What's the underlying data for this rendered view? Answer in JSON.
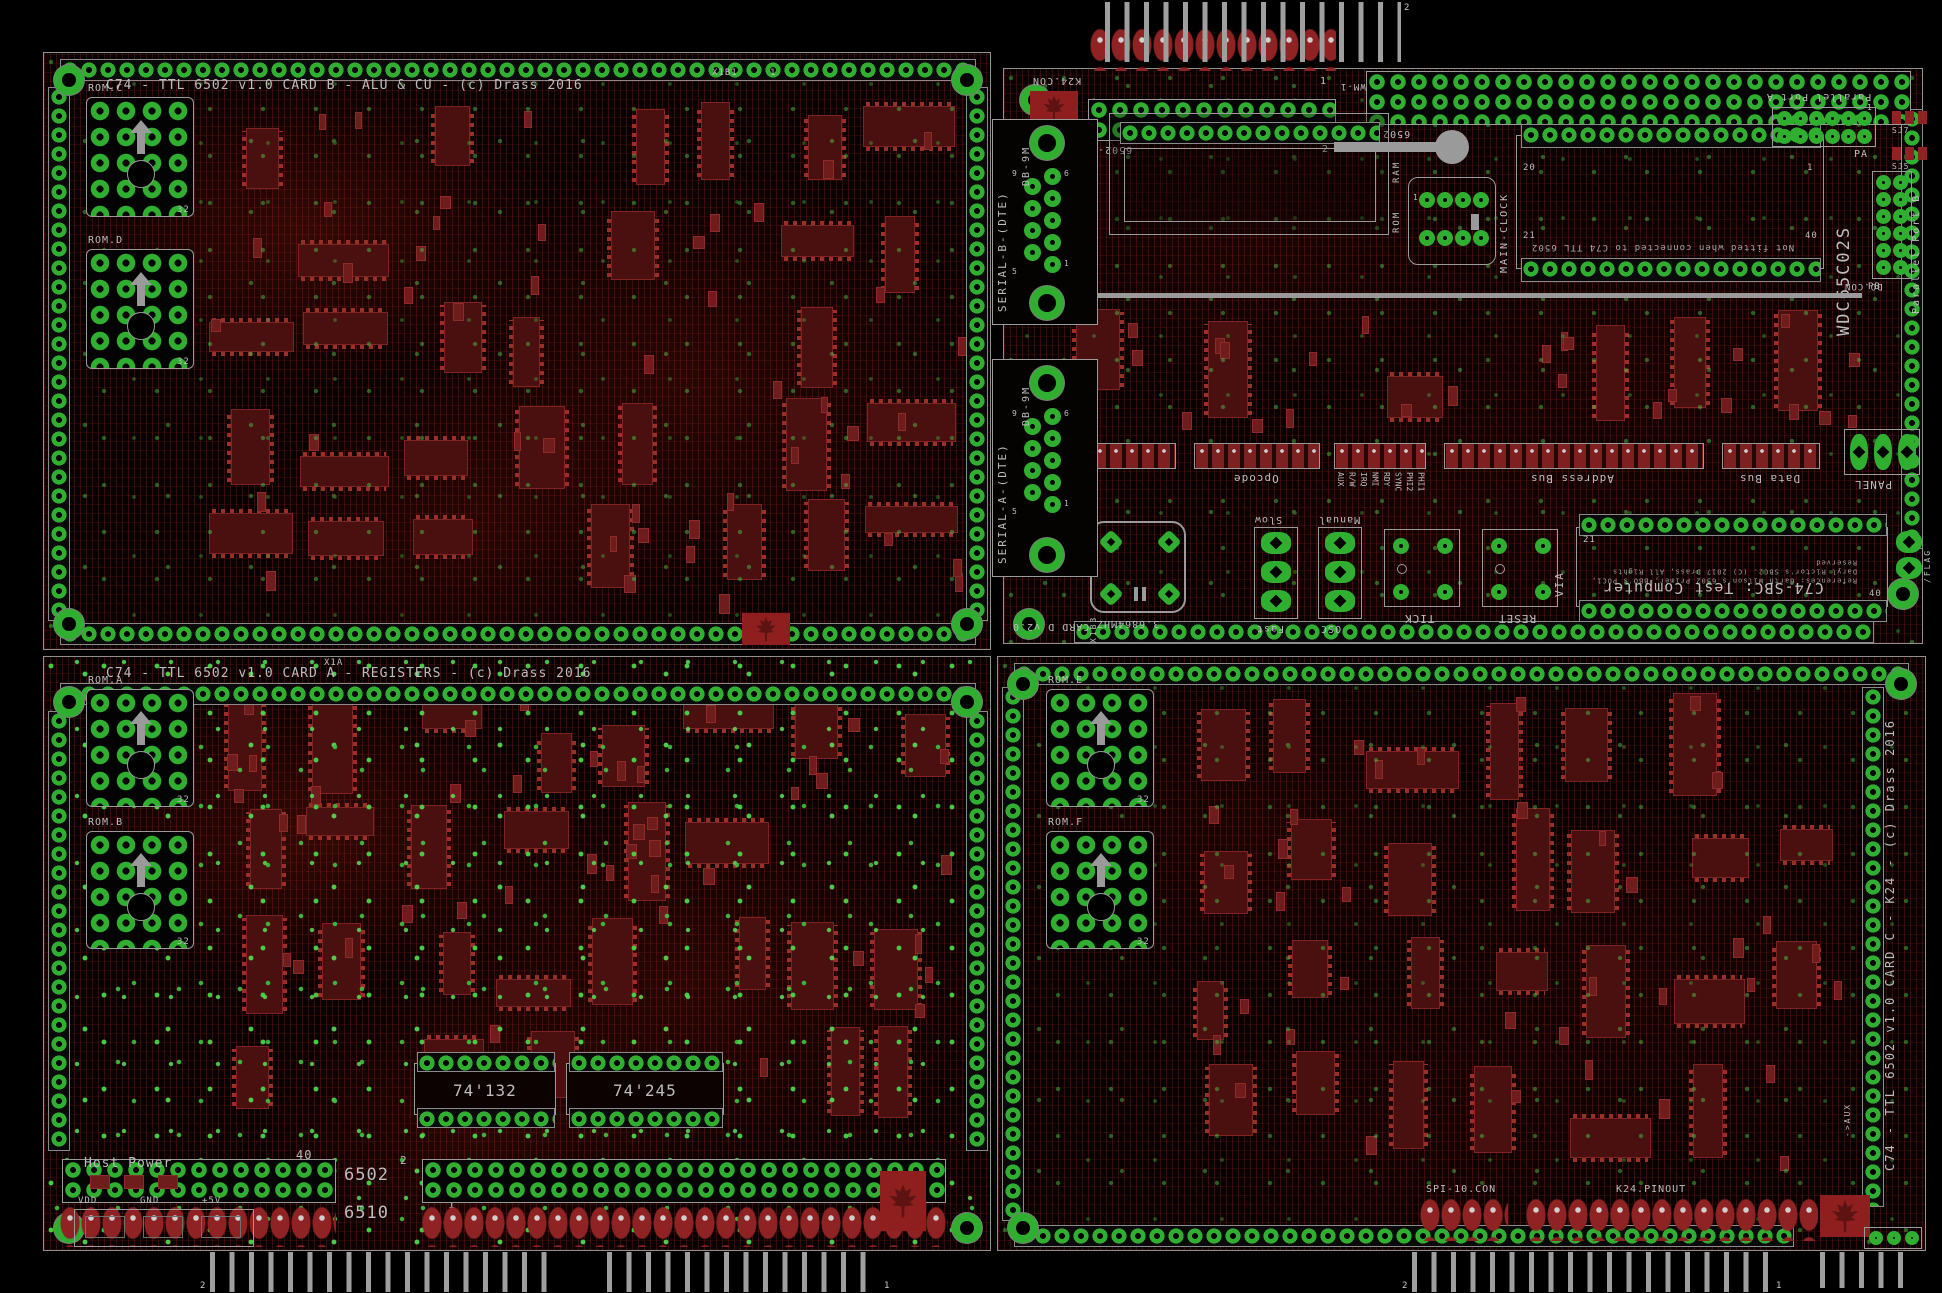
{
  "page": {
    "width": 1942,
    "height": 1293,
    "background": "#000000"
  },
  "colors": {
    "pad_green": "#2fae2f",
    "trace_red": "#9e2b23",
    "ic_red": "#4a1010",
    "led_red": "#7e2020",
    "silkscreen": "#bdbdbd",
    "gray_graphic": "#9a9a9a"
  },
  "boards": [
    {
      "id": "card-b",
      "x": 43,
      "y": 52,
      "w": 948,
      "h": 598,
      "title": {
        "text": "C74 - TTL 6502 v1.0 CARD B - ALU & CU - (c) Drass 2016",
        "x": 62,
        "y": 26,
        "size": 13
      },
      "edges": {
        "top": [
          16,
          6,
          916
        ],
        "bottom": [
          16,
          570,
          916
        ],
        "left": [
          4,
          34,
          534
        ],
        "right": [
          922,
          34,
          534
        ]
      },
      "mounts": [
        [
          10,
          12
        ],
        [
          908,
          12
        ],
        [
          10,
          556
        ],
        [
          908,
          556
        ]
      ],
      "components": [
        {
          "t": "plcc",
          "label": "ROM.C",
          "pins": "32",
          "x": 42,
          "y": 44,
          "w": 108,
          "h": 120
        },
        {
          "t": "plcc",
          "label": "ROM.D",
          "pins": "32",
          "x": 42,
          "y": 196,
          "w": 108,
          "h": 120
        },
        {
          "t": "text",
          "label": "X1B1",
          "x": 668,
          "y": 16,
          "size": 9
        },
        {
          "t": "text",
          "label": "1",
          "x": 726,
          "y": 16,
          "size": 9
        },
        {
          "t": "leaf",
          "x": 698,
          "y": 560,
          "w": 48,
          "h": 32
        }
      ]
    },
    {
      "id": "card-d",
      "x": 1003,
      "y": 68,
      "w": 920,
      "h": 576,
      "title": null,
      "edges": {
        "bottom": [
          70,
          552,
          800
        ],
        "right": [
          897,
          40,
          440
        ]
      },
      "mounts": [
        [
          16,
          16
        ],
        [
          884,
          510
        ],
        [
          10,
          540
        ]
      ],
      "components": [
        {
          "t": "text",
          "label": "K24.CON",
          "x": 28,
          "y": 6,
          "size": 10,
          "rot": 180
        },
        {
          "t": "leaf",
          "x": 26,
          "y": 22,
          "w": 48,
          "h": 34
        },
        {
          "t": "rrowblk",
          "x": 86,
          "y": -42,
          "w": 246,
          "h": 44
        },
        {
          "t": "dual",
          "label": "6502-B",
          "x": 84,
          "y": 30,
          "w": 248,
          "h": 42,
          "lrot": 180
        },
        {
          "t": "text",
          "label": "1",
          "x": 316,
          "y": 8,
          "size": 10
        },
        {
          "t": "text",
          "label": "2",
          "x": 318,
          "y": 76,
          "size": 10
        },
        {
          "t": "text",
          "label": "WM-1",
          "x": 336,
          "y": 12,
          "size": 9,
          "rot": 180
        },
        {
          "t": "dual",
          "label": "6502-A",
          "x": 362,
          "y": 2,
          "w": 545,
          "h": 54,
          "lrot": 180
        },
        {
          "t": "sockbox",
          "x": 105,
          "y": 44,
          "w": 280,
          "h": 122,
          "strip": [
            10,
            8,
            260
          ],
          "vlabels": [
            {
              "text": "RAM",
              "x": 284,
              "y": 30
            },
            {
              "text": "ROM",
              "x": 284,
              "y": 80
            }
          ]
        },
        {
          "t": "key",
          "x": 330,
          "y": 58,
          "w": 135,
          "h": 40
        },
        {
          "t": "clock8",
          "label": "MAIN-CLOCK",
          "x": 404,
          "y": 108,
          "w": 88,
          "h": 88
        },
        {
          "t": "dip40",
          "x": 512,
          "y": 66,
          "w": 308,
          "h": 134,
          "label": "Not fitted when connected to C74 TTL 6502",
          "pins": [
            {
              "text": "20",
              "x": 6,
              "y": 28
            },
            {
              "text": "1",
              "x": 290,
              "y": 28
            },
            {
              "text": "21",
              "x": 6,
              "y": 96
            },
            {
              "text": "40",
              "x": 288,
              "y": 96
            }
          ]
        },
        {
          "t": "vtext",
          "label": "WDC65C02S",
          "x": 832,
          "y": 92,
          "h": 175,
          "size": 17
        },
        {
          "t": "text",
          "label": "Parallel Port A",
          "x": 762,
          "y": 22,
          "size": 10,
          "rot": 180
        },
        {
          "t": "hdr2x6",
          "label": "PA",
          "x": 768,
          "y": 38,
          "w": 104,
          "h": 40
        },
        {
          "t": "sj",
          "label": "SJ7",
          "x": 886,
          "y": 42
        },
        {
          "t": "sj",
          "label": "SJ5",
          "x": 886,
          "y": 78
        },
        {
          "t": "hdr2x6v",
          "label": "PB",
          "x": 868,
          "y": 102,
          "w": 40,
          "h": 108
        },
        {
          "t": "vtext",
          "label": "Parallel Port B",
          "x": 908,
          "y": 100,
          "h": 145,
          "size": 10
        },
        {
          "t": "text",
          "label": "DO.CON",
          "x": 840,
          "y": 212,
          "size": 9,
          "rot": 180
        },
        {
          "t": "bus",
          "x": 58,
          "y": 224,
          "w": 800,
          "h": 5
        },
        {
          "t": "ledarr",
          "n": 8,
          "x": 88,
          "y": 374,
          "w": 84,
          "h": 26
        },
        {
          "t": "ledarr",
          "n": 8,
          "x": 190,
          "y": 374,
          "w": 126,
          "h": 26,
          "label": "Opcode",
          "lrot": 180
        },
        {
          "t": "ledarr",
          "n": 8,
          "x": 330,
          "y": 374,
          "w": 92,
          "h": 26,
          "signals": [
            "AUX",
            "R/W",
            "IRQ",
            "NMI",
            "RDY",
            "SYNC",
            "PHI2",
            "PHI1"
          ]
        },
        {
          "t": "ledarr",
          "n": 16,
          "x": 440,
          "y": 374,
          "w": 260,
          "h": 26,
          "label": "Address Bus",
          "lrot": 180
        },
        {
          "t": "ledarr",
          "n": 8,
          "x": 718,
          "y": 374,
          "w": 98,
          "h": 26,
          "label": "Data Bus",
          "lrot": 180
        },
        {
          "t": "panel3",
          "label": "PANEL",
          "x": 840,
          "y": 360,
          "w": 76,
          "h": 46,
          "lrot": 180
        },
        {
          "t": "crystal",
          "label": "3.6864MHZ",
          "x": 86,
          "y": 452,
          "w": 96,
          "h": 92,
          "lrot": 180
        },
        {
          "t": "jumper3",
          "top": "Slow",
          "bottom": "Fast",
          "x": 250,
          "y": 458,
          "w": 44,
          "h": 92
        },
        {
          "t": "jumper3",
          "top": "Manual",
          "bottom": "OSC",
          "x": 314,
          "y": 458,
          "w": 44,
          "h": 92
        },
        {
          "t": "button",
          "label": "TICK",
          "x": 380,
          "y": 460,
          "w": 76,
          "h": 78,
          "lrot": 180
        },
        {
          "t": "button",
          "label": "RESET",
          "x": 478,
          "y": 460,
          "w": 76,
          "h": 78,
          "lrot": 180
        },
        {
          "t": "vtext",
          "label": "VIA",
          "x": 550,
          "y": 468,
          "h": 60,
          "size": 11
        },
        {
          "t": "viasock",
          "x": 572,
          "y": 458,
          "w": 312,
          "h": 80,
          "title": "C74-SBC: Test Computer",
          "refs": "References: Garth Wilson's 6502 Primer, BBO's POC1, Daryl Rictor's SBC2. (C) 2017 Drass, All Rights Reserved",
          "pins": [
            {
              "text": "21",
              "x": 6,
              "y": 8
            },
            {
              "text": "40",
              "x": 292,
              "y": 62
            }
          ]
        },
        {
          "t": "flag",
          "label": "/FLAG",
          "x": 892,
          "y": 462
        },
        {
          "t": "text",
          "label": "CARD D v2.0",
          "x": 8,
          "y": 552,
          "size": 10,
          "rot": 180
        },
        {
          "t": "vtext",
          "label": "X1B3",
          "x": 86,
          "y": 540,
          "h": 34,
          "size": 8
        },
        {
          "t": "db9",
          "label": "SERIAL-B-(DTE)",
          "sub": "DB-9M",
          "nums": [
            "9",
            "6",
            "5",
            "1"
          ],
          "x": -12,
          "y": 50,
          "w": 106,
          "h": 206
        },
        {
          "t": "db9",
          "label": "SERIAL-A-(DTE)",
          "sub": "DB-9M",
          "nums": [
            "9",
            "6",
            "5",
            "1"
          ],
          "x": -12,
          "y": 290,
          "w": 106,
          "h": 218
        }
      ]
    },
    {
      "id": "card-a",
      "x": 43,
      "y": 656,
      "w": 948,
      "h": 595,
      "title": {
        "text": "C74 - TTL 6502 v1.0 CARD A - REGISTERS - (c) Drass 2016",
        "x": 62,
        "y": 10,
        "size": 13
      },
      "edges": {
        "top": [
          16,
          26,
          916
        ],
        "left": [
          4,
          54,
          440
        ],
        "right": [
          922,
          54,
          440
        ]
      },
      "mounts": [
        [
          10,
          30
        ],
        [
          908,
          30
        ],
        [
          10,
          556
        ],
        [
          908,
          556
        ]
      ],
      "components": [
        {
          "t": "text",
          "label": "X1A",
          "x": 280,
          "y": 2,
          "size": 9
        },
        {
          "t": "plcc",
          "label": "ROM.A",
          "pins": "32",
          "x": 42,
          "y": 32,
          "w": 108,
          "h": 118
        },
        {
          "t": "plcc",
          "label": "ROM.B",
          "pins": "32",
          "x": 42,
          "y": 174,
          "w": 108,
          "h": 118
        },
        {
          "t": "icdip",
          "label": "74'132",
          "x": 370,
          "y": 406,
          "w": 142,
          "h": 52
        },
        {
          "t": "icdip",
          "label": "74'245",
          "x": 522,
          "y": 406,
          "w": 158,
          "h": 52
        },
        {
          "t": "text",
          "label": "40",
          "x": 252,
          "y": 492,
          "size": 12
        },
        {
          "t": "text",
          "label": "2",
          "x": 356,
          "y": 498,
          "size": 11
        },
        {
          "t": "text",
          "label": "6502",
          "x": 300,
          "y": 510,
          "size": 17
        },
        {
          "t": "text",
          "label": "1",
          "x": 404,
          "y": 542,
          "size": 11
        },
        {
          "t": "text",
          "label": "6510",
          "x": 300,
          "y": 548,
          "size": 17
        },
        {
          "t": "dual",
          "x": 18,
          "y": 502,
          "w": 274,
          "h": 44
        },
        {
          "t": "dual",
          "x": 378,
          "y": 502,
          "w": 524,
          "h": 44
        },
        {
          "t": "rrowblk",
          "x": 16,
          "y": 548,
          "w": 276,
          "h": 42
        },
        {
          "t": "rrowblk",
          "x": 378,
          "y": 548,
          "w": 526,
          "h": 42
        },
        {
          "t": "hostpower",
          "label": "Host Power",
          "pins": [
            "VDD",
            "GND",
            "+5V"
          ],
          "x": 26,
          "y": 488,
          "w": 210,
          "h": 104
        },
        {
          "t": "leaf",
          "x": 836,
          "y": 514,
          "w": 46,
          "h": 60
        }
      ]
    },
    {
      "id": "card-c",
      "x": 997,
      "y": 656,
      "w": 929,
      "h": 595,
      "title": {
        "text": "C74 - TTL 6502 v1.0 CARD C - K24 - (c) Drass 2016",
        "vertical": true,
        "x": 886,
        "y": 64,
        "vh": 450,
        "size": 12
      },
      "edges": {
        "top": [
          16,
          6,
          895
        ],
        "bottom": [
          16,
          568,
          780
        ],
        "left": [
          4,
          30,
          534
        ],
        "right": [
          864,
          30,
          520
        ]
      },
      "mounts": [
        [
          10,
          12
        ],
        [
          888,
          12
        ],
        [
          10,
          556
        ]
      ],
      "components": [
        {
          "t": "plcc",
          "label": "ROM.E",
          "pins": "32",
          "x": 48,
          "y": 32,
          "w": 108,
          "h": 118
        },
        {
          "t": "plcc",
          "label": "ROM.F",
          "pins": "32",
          "x": 48,
          "y": 174,
          "w": 108,
          "h": 118
        },
        {
          "t": "vtext",
          "label": "->AUX",
          "x": 846,
          "y": 430,
          "h": 50,
          "size": 8
        },
        {
          "t": "text",
          "label": "SPI-10.CON",
          "x": 428,
          "y": 528,
          "size": 10
        },
        {
          "t": "rrowblk",
          "x": 422,
          "y": 540,
          "w": 88,
          "h": 44
        },
        {
          "t": "text",
          "label": "K24.PINOUT",
          "x": 618,
          "y": 528,
          "size": 10
        },
        {
          "t": "rrowblk",
          "x": 528,
          "y": 540,
          "w": 292,
          "h": 44
        },
        {
          "t": "leaf",
          "x": 822,
          "y": 538,
          "w": 50,
          "h": 42
        },
        {
          "t": "panel3h",
          "x": 866,
          "y": 570,
          "w": 58,
          "h": 22
        }
      ]
    }
  ],
  "combs": [
    {
      "x": 1105,
      "y": 2,
      "w": 296,
      "h": 60
    },
    {
      "x": 210,
      "y": 1252,
      "w": 347,
      "h": 40
    },
    {
      "x": 607,
      "y": 1252,
      "w": 272,
      "h": 40
    },
    {
      "x": 1412,
      "y": 1252,
      "w": 359,
      "h": 40
    },
    {
      "x": 1820,
      "y": 1252,
      "w": 88,
      "h": 36
    }
  ],
  "marks": [
    {
      "text": "2",
      "x": 1404,
      "y": 4
    },
    {
      "text": "2",
      "x": 200,
      "y": 1282
    },
    {
      "text": "1",
      "x": 884,
      "y": 1282
    },
    {
      "text": "2",
      "x": 1402,
      "y": 1282
    },
    {
      "text": "1",
      "x": 1776,
      "y": 1282
    }
  ]
}
